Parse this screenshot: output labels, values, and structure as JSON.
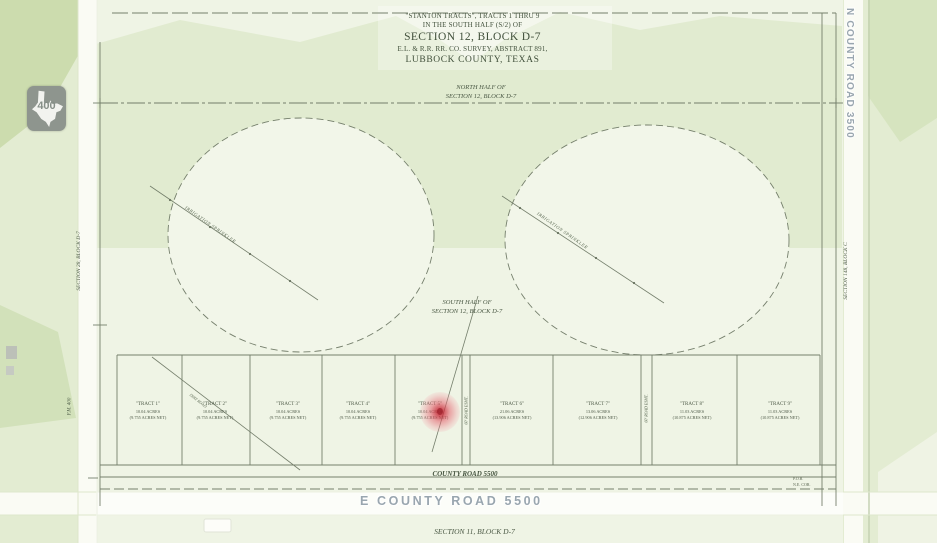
{
  "map": {
    "bottom_road_label": "E COUNTY ROAD 5500",
    "right_road_label": "N COUNTY ROAD 3500",
    "shield_route": "400"
  },
  "plat": {
    "title_line1": "\"STANTON TRACTS\", TRACTS 1 THRU 9",
    "title_line2": "IN THE SOUTH HALF (S/2) OF",
    "title_line3": "SECTION 12, BLOCK D-7",
    "title_line4": "E.L. & R.R. RR. CO. SURVEY, ABSTRACT 891,",
    "title_line5": "LUBBOCK COUNTY, TEXAS",
    "north_half_line1": "NORTH HALF OF",
    "north_half_line2": "SECTION 12, BLOCK D-7",
    "south_half_line1": "SOUTH HALF OF",
    "south_half_line2": "SECTION 12, BLOCK D-7",
    "county_road": "COUNTY ROAD  5500",
    "section_south": "SECTION 11, BLOCK D-7",
    "section_west": "SECTION 28, BLOCK D-7",
    "section_east": "SECTION 148, BLOCK C",
    "fm_road": "F.M. 400",
    "irrigation_left": "IRRIGATION SPRINKLER",
    "irrigation_right": "IRRIGATION SPRINKLER",
    "road_easement_left": "60' ROAD ESMT.",
    "road_easement_right": "60' ROAD ESMT.",
    "dirt_road": "DIRT ROAD",
    "corner_note_line1": "P.O.B.",
    "corner_note_line2": "N.E. COR.",
    "tracts": [
      {
        "name": "\"TRACT 1\"",
        "acres": "10.04 ACRES",
        "net": "(9.755 ACRES NET)"
      },
      {
        "name": "\"TRACT 2\"",
        "acres": "10.04 ACRES",
        "net": "(9.755 ACRES NET)"
      },
      {
        "name": "\"TRACT 3\"",
        "acres": "10.04 ACRES",
        "net": "(9.755 ACRES NET)"
      },
      {
        "name": "\"TRACT 4\"",
        "acres": "10.04 ACRES",
        "net": "(9.755 ACRES NET)"
      },
      {
        "name": "\"TRACT 5\"",
        "acres": "10.04 ACRES",
        "net": "(9.755 ACRES NET)"
      },
      {
        "name": "\"TRACT 6\"",
        "acres": "21.06 ACRES",
        "net": "(13.906 ACRES NET)"
      },
      {
        "name": "\"TRACT 7\"",
        "acres": "13.06 ACRES",
        "net": "(12.906 ACRES NET)"
      },
      {
        "name": "\"TRACT 8\"",
        "acres": "11.03 ACRES",
        "net": "(10.875 ACRES NET)"
      },
      {
        "name": "\"TRACT 9\"",
        "acres": "11.03 ACRES",
        "net": "(10.875 ACRES NET)"
      }
    ]
  },
  "colors": {
    "map_base": "#e3ecd2",
    "map_dark_green": "#ccdcae",
    "road_white": "#fafbf4",
    "plat_ink": "#44523e",
    "map_label_gray": "#99a6af",
    "marker_red": "#c82837"
  }
}
